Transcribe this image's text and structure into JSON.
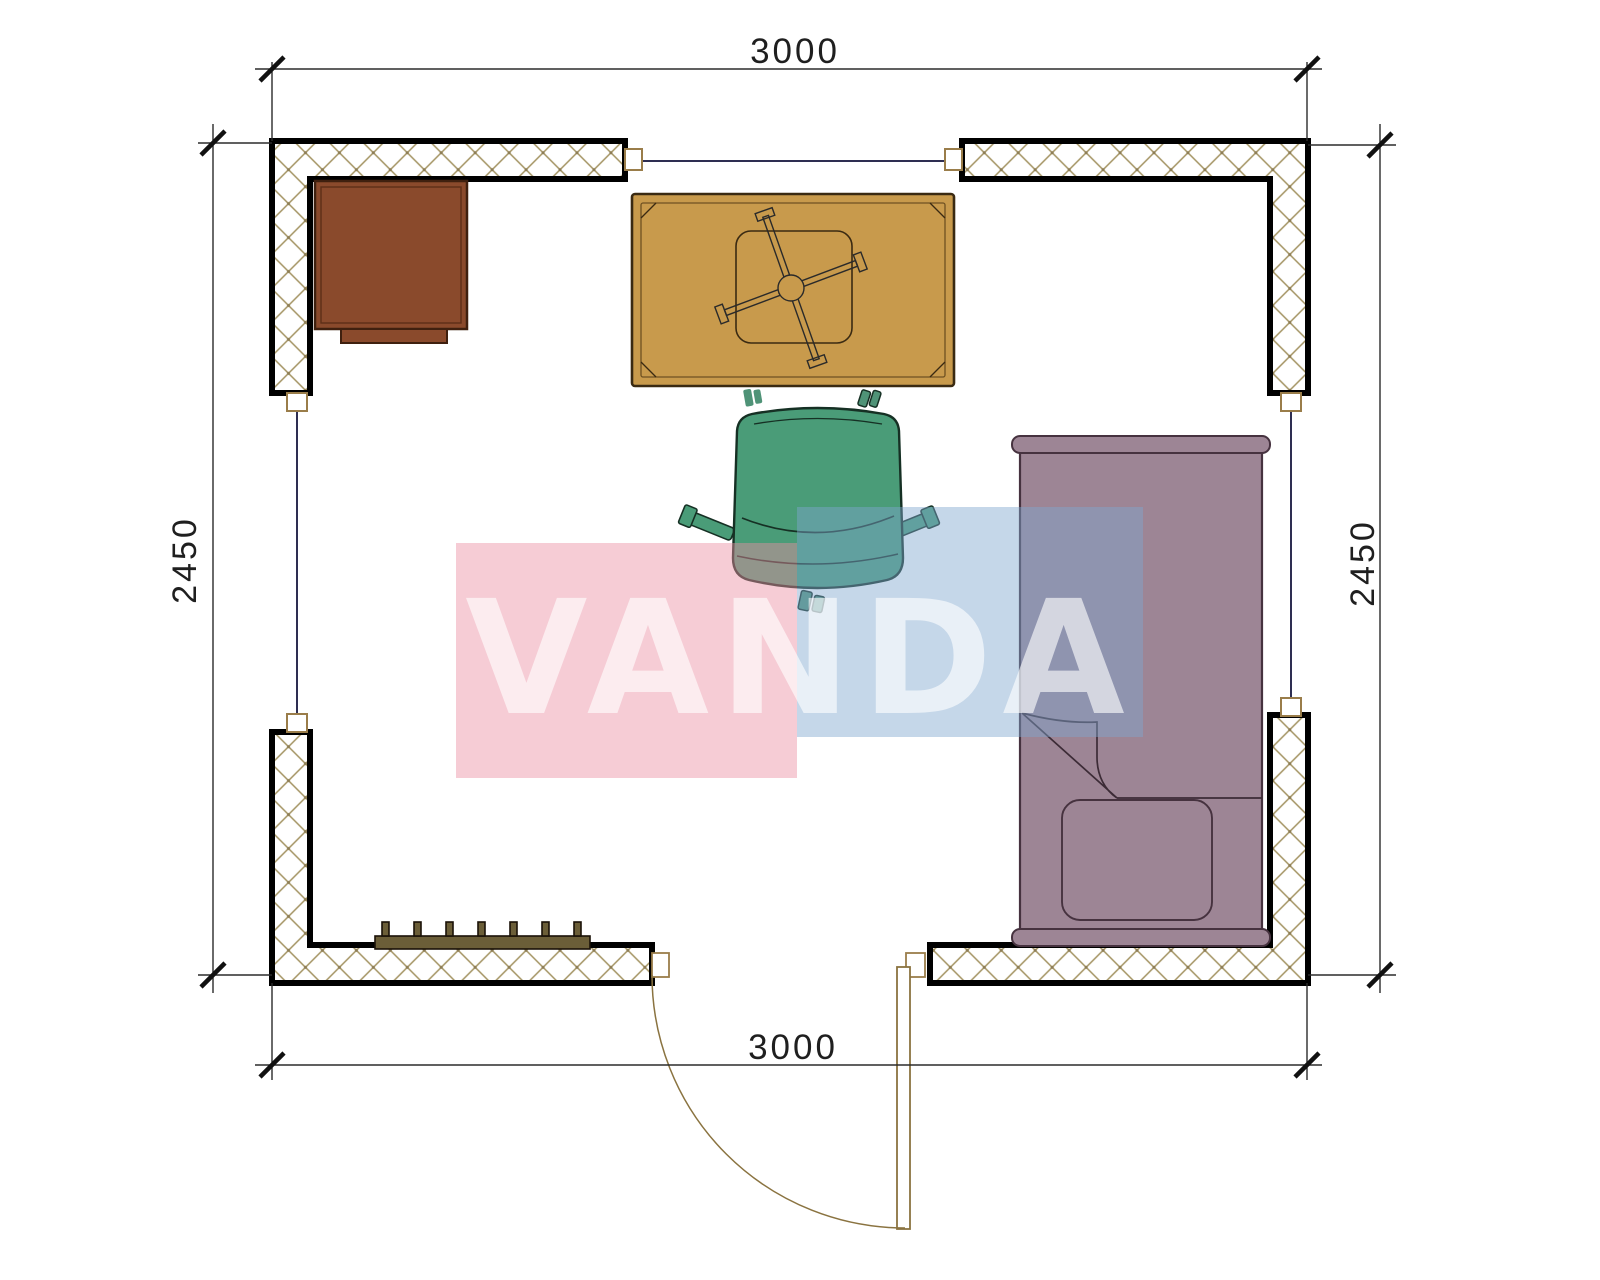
{
  "page": {
    "title": "floor-plan-3000x2450",
    "background": "#ffffff"
  },
  "dimensions": {
    "top": "3000",
    "bottom": "3000",
    "left": "2450",
    "right": "2450"
  },
  "watermark": {
    "text": "VANDA",
    "pink_block_color": "rgba(235,142,162,0.45)",
    "blue_block_color": "rgba(126,166,206,0.45)",
    "text_color": "rgba(255,255,255,0.62)"
  },
  "colors": {
    "wall_hatch": "#a39362",
    "wall_outline": "#000000",
    "window_line": "#2e2e52",
    "window_frame": "#9a7d4a",
    "door": "#8a7340",
    "cabinet": "#8a4a2c",
    "cabinet_outline": "#3f200f",
    "table": "#c89a4c",
    "table_outline": "#3a2a12",
    "chair": "#4a9c78",
    "chair_outline": "#163024",
    "bed": "#9d8595",
    "bed_outline": "#46323f",
    "radiator": "#6b5e38",
    "dimension_line": "#2b2b2b",
    "dimension_text": "#1f1f1f"
  },
  "furniture": [
    {
      "name": "cabinet",
      "location": "top-left"
    },
    {
      "name": "table-with-cross-base",
      "location": "top-center"
    },
    {
      "name": "office-chair",
      "location": "center"
    },
    {
      "name": "bed-with-pillow",
      "location": "right"
    },
    {
      "name": "radiator",
      "location": "bottom-left"
    },
    {
      "name": "door-with-swing",
      "location": "bottom-center"
    }
  ]
}
